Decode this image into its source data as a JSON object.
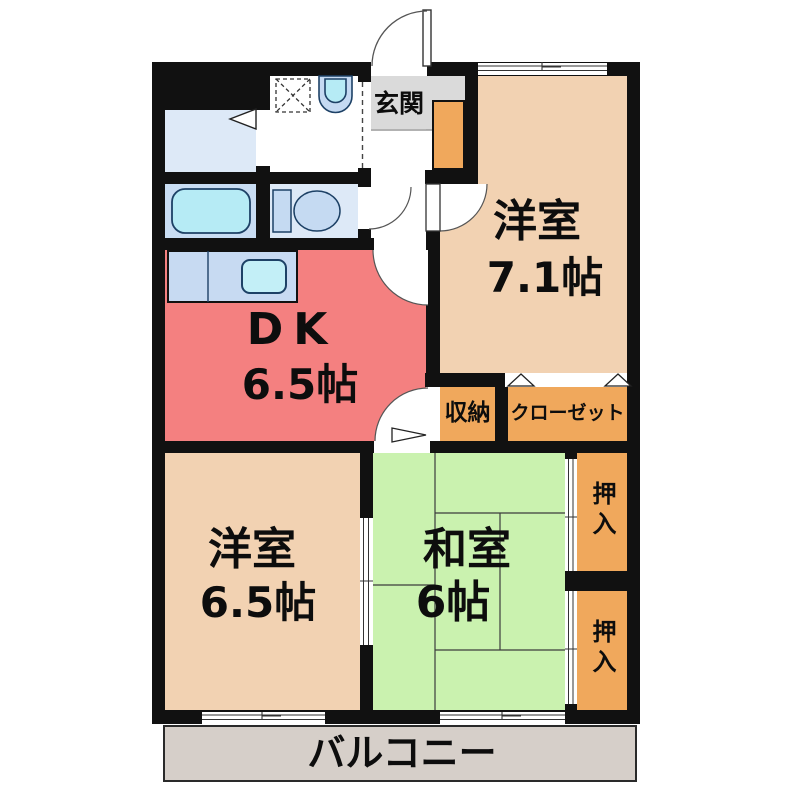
{
  "floor_plan": {
    "rooms": {
      "genkan": {
        "label": "玄関"
      },
      "western1": {
        "label": "洋室",
        "size": "7.1帖"
      },
      "dk": {
        "label": "DK",
        "size": "6.5帖"
      },
      "storage": {
        "label": "収納"
      },
      "closet": {
        "label": "クローゼット"
      },
      "western2": {
        "label": "洋室",
        "size": "6.5帖"
      },
      "japanese": {
        "label": "和室",
        "size": "6帖"
      },
      "oshiire_top": {
        "label": "押入"
      },
      "oshiire_bottom": {
        "label": "押入"
      },
      "balcony": {
        "label": "バルコニー"
      }
    },
    "fixtures": [
      "bathtub",
      "wash-basin",
      "washing-machine-pan",
      "toilet",
      "kitchen-sink",
      "shoe-cabinet"
    ],
    "doors": [
      "entrance-swing-door",
      "toilet-swing-door",
      "western1-swing-door",
      "dk-swing-door",
      "japanese-room-swing-door",
      "bath-folding-door",
      "closet-folding-doors",
      "storage-folding-door",
      "sliding-door-western2-japanese",
      "sliding-doors-oshiire"
    ],
    "windows": [
      "top-window",
      "balcony-window-left",
      "balcony-window-right"
    ]
  },
  "colors": {
    "wall": "#111111",
    "dk_fill": "#F48080",
    "western_fill": "#F2D2B2",
    "tatami_fill": "#CAF2AF",
    "storage_fill": "#F0A85C",
    "genkan_fill": "#DADADA",
    "balcony_fill": "#D6CFC9",
    "bathroom_fill": "#DDE9F7",
    "bath_tub_room": "#C9DDF3",
    "counter_fill": "#C7DAF2",
    "fixture_fill": "#C5DAF2",
    "water_fill": "#B6EBF5",
    "sink_fill": "#C3EFF7",
    "line_dark": "#1d4166"
  }
}
